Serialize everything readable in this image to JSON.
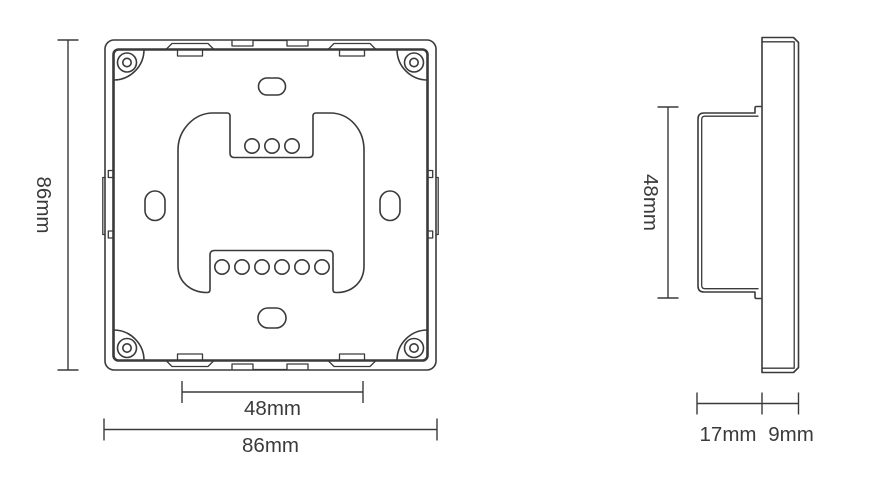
{
  "drawing_type": "panel-dimension-drawing",
  "colors": {
    "line": "#3a3a3a",
    "background": "#ffffff"
  },
  "front_view": {
    "height_label": "86mm",
    "width_label": "86mm",
    "mount_spacing_label": "48mm",
    "corner_screw_count": 4,
    "top_pin_count": 3,
    "bottom_pin_count": 6
  },
  "side_view": {
    "height_label": "48mm",
    "body_depth_label": "17mm",
    "panel_depth_label": "9mm"
  }
}
